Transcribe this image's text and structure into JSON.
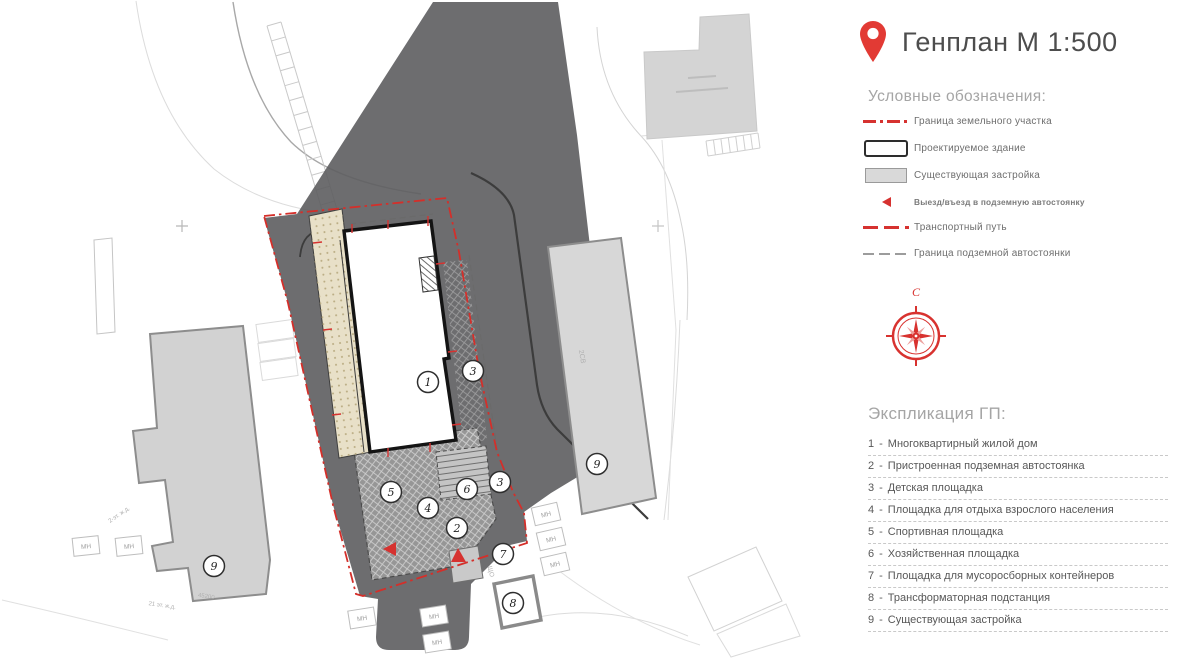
{
  "title": {
    "text": "Генплан М 1:500"
  },
  "legend": {
    "heading": "Условные обозначения:",
    "items": [
      {
        "symbol": "dashdot",
        "label": "Граница земельного участка",
        "small": false
      },
      {
        "symbol": "rect",
        "label": "Проектируемое здание",
        "small": false
      },
      {
        "symbol": "gray",
        "label": "Существующая застройка",
        "small": false
      },
      {
        "symbol": "tri",
        "label": "Выезд/въезд в подземную автостоянку",
        "small": true
      },
      {
        "symbol": "reddash",
        "label": "Транспортный путь",
        "small": false
      },
      {
        "symbol": "graydash",
        "label": "Граница подземной автостоянки",
        "small": false
      }
    ]
  },
  "compass": {
    "north_label": "С"
  },
  "explication": {
    "heading": "Экспликация ГП:",
    "sep": "-",
    "items": [
      {
        "num": "1",
        "label": "Многоквартирный жилой дом"
      },
      {
        "num": "2",
        "label": "Пристроенная подземная автостоянка"
      },
      {
        "num": "3",
        "label": "Детская площадка"
      },
      {
        "num": "4",
        "label": "Площадка для отдыха взрослого населения"
      },
      {
        "num": "5",
        "label": "Спортивная площадка"
      },
      {
        "num": "6",
        "label": "Хозяйственная площадка"
      },
      {
        "num": "7",
        "label": "Площадка для мусоросборных контейнеров"
      },
      {
        "num": "8",
        "label": "Трансформаторная подстанция"
      },
      {
        "num": "9",
        "label": "Существующая застройка"
      }
    ]
  },
  "plan": {
    "mn_label": "МН",
    "circles": [
      {
        "x": 428,
        "y": 382,
        "n": "1"
      },
      {
        "x": 473,
        "y": 371,
        "n": "3"
      },
      {
        "x": 500,
        "y": 482,
        "n": "3"
      },
      {
        "x": 467,
        "y": 489,
        "n": "6"
      },
      {
        "x": 391,
        "y": 492,
        "n": "5"
      },
      {
        "x": 428,
        "y": 508,
        "n": "4"
      },
      {
        "x": 457,
        "y": 528,
        "n": "2"
      },
      {
        "x": 503,
        "y": 554,
        "n": "7"
      },
      {
        "x": 513,
        "y": 603,
        "n": "8"
      },
      {
        "x": 214,
        "y": 566,
        "n": "9"
      },
      {
        "x": 597,
        "y": 464,
        "n": "9"
      }
    ],
    "mn_boxes": [
      {
        "x": 546,
        "y": 514,
        "r": -13
      },
      {
        "x": 551,
        "y": 539,
        "r": -13
      },
      {
        "x": 555,
        "y": 564,
        "r": -13
      },
      {
        "x": 362,
        "y": 618,
        "r": -9
      },
      {
        "x": 434,
        "y": 616,
        "r": -9
      },
      {
        "x": 437,
        "y": 642,
        "r": -9
      },
      {
        "x": 86,
        "y": 546,
        "r": -6
      },
      {
        "x": 129,
        "y": 546,
        "r": -6
      }
    ],
    "small_texts": [
      {
        "x": 580,
        "y": 357,
        "rot": 80,
        "size": 7,
        "text": "2СВ"
      },
      {
        "x": 489,
        "y": 572,
        "rot": 76,
        "size": 6.5,
        "text": "ЩО"
      },
      {
        "x": 206,
        "y": 598,
        "rot": 9,
        "size": 6,
        "text": "45200"
      },
      {
        "x": 120,
        "y": 516,
        "rot": -35,
        "size": 6,
        "text": "2-эт. ж.д."
      },
      {
        "x": 162,
        "y": 607,
        "rot": 8,
        "size": 6,
        "text": "21 эт. ж.д."
      }
    ]
  }
}
